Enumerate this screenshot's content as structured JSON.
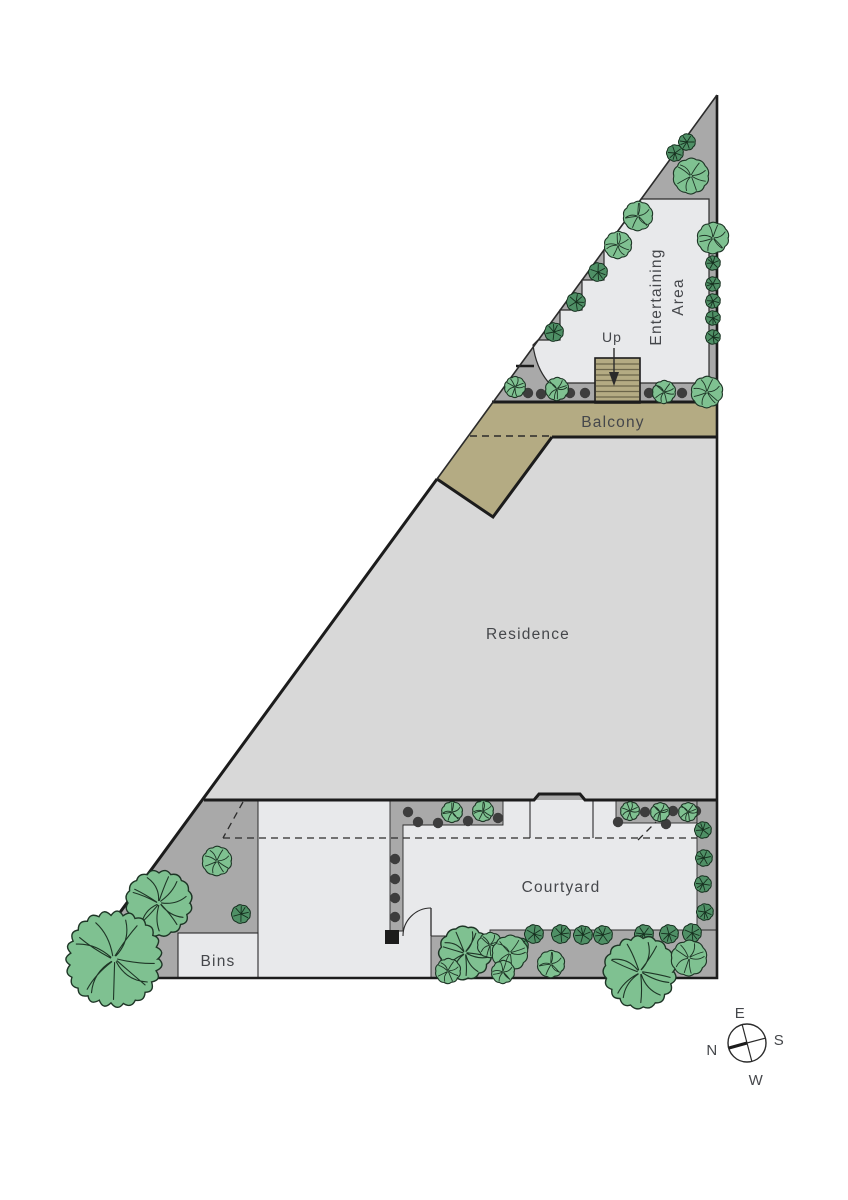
{
  "labels": {
    "residence": "Residence",
    "balcony": "Balcony",
    "courtyard": "Courtyard",
    "bins": "Bins",
    "up": "Up",
    "entertaining_line1": "Entertaining",
    "entertaining_line2": "Area"
  },
  "compass": {
    "top": "E",
    "right": "S",
    "bottom": "W",
    "left": "N"
  },
  "colors": {
    "background": "#ffffff",
    "planted_gray": "#a9a9a9",
    "deck_light": "#e8e9eb",
    "residence_gray": "#d8d8d8",
    "balcony_khaki": "#b4ab83",
    "stair_tread_line": "#6b654a",
    "wall_black": "#1c1c1c",
    "thin_line": "#2b2b2b",
    "label_text": "#45474b",
    "tree_fill": "#7fc191",
    "tree_stroke": "#1e3526",
    "shrub_fill": "#4f9066",
    "shrub_stroke": "#16301f",
    "dot_fill": "#3d3d3d"
  },
  "vegetation": {
    "trees": [
      [
        691,
        176,
        17
      ],
      [
        713,
        238,
        15
      ],
      [
        638,
        216,
        14
      ],
      [
        618,
        245,
        13
      ],
      [
        515,
        387,
        10
      ],
      [
        557,
        389,
        11
      ],
      [
        664,
        392,
        11
      ],
      [
        707,
        392,
        15
      ],
      [
        452,
        812,
        10
      ],
      [
        483,
        811,
        10
      ],
      [
        630,
        811,
        9
      ],
      [
        660,
        812,
        9
      ],
      [
        688,
        812,
        9
      ],
      [
        217,
        861,
        14
      ],
      [
        159,
        903,
        31
      ],
      [
        114,
        959,
        45
      ],
      [
        465,
        953,
        25
      ],
      [
        490,
        945,
        12
      ],
      [
        510,
        953,
        17
      ],
      [
        448,
        971,
        12
      ],
      [
        503,
        972,
        11
      ],
      [
        551,
        964,
        13
      ],
      [
        640,
        972,
        34
      ],
      [
        689,
        958,
        17
      ]
    ],
    "shrubs": [
      [
        687,
        142,
        8
      ],
      [
        675,
        153,
        8
      ],
      [
        598,
        272,
        9
      ],
      [
        576,
        302,
        9
      ],
      [
        554,
        332,
        9
      ],
      [
        713,
        263,
        7
      ],
      [
        713,
        284,
        7
      ],
      [
        713,
        301,
        7
      ],
      [
        713,
        318,
        7
      ],
      [
        713,
        337,
        7
      ],
      [
        241,
        914,
        9
      ],
      [
        703,
        830,
        8
      ],
      [
        704,
        858,
        8
      ],
      [
        703,
        884,
        8
      ],
      [
        705,
        912,
        8
      ],
      [
        534,
        934,
        9
      ],
      [
        561,
        934,
        9
      ],
      [
        583,
        935,
        9
      ],
      [
        603,
        935,
        9
      ],
      [
        644,
        934,
        9
      ],
      [
        669,
        934,
        9
      ],
      [
        692,
        933,
        9
      ],
      [
        520,
        946,
        8
      ]
    ],
    "dots": [
      [
        528,
        393
      ],
      [
        541,
        394
      ],
      [
        570,
        393
      ],
      [
        585,
        393
      ],
      [
        649,
        393
      ],
      [
        682,
        393
      ],
      [
        408,
        812
      ],
      [
        418,
        822
      ],
      [
        438,
        823
      ],
      [
        468,
        821
      ],
      [
        498,
        818
      ],
      [
        395,
        859
      ],
      [
        395,
        879
      ],
      [
        395,
        898
      ],
      [
        395,
        917
      ],
      [
        645,
        812
      ],
      [
        673,
        811
      ],
      [
        696,
        811
      ],
      [
        618,
        822
      ],
      [
        666,
        824
      ]
    ]
  }
}
